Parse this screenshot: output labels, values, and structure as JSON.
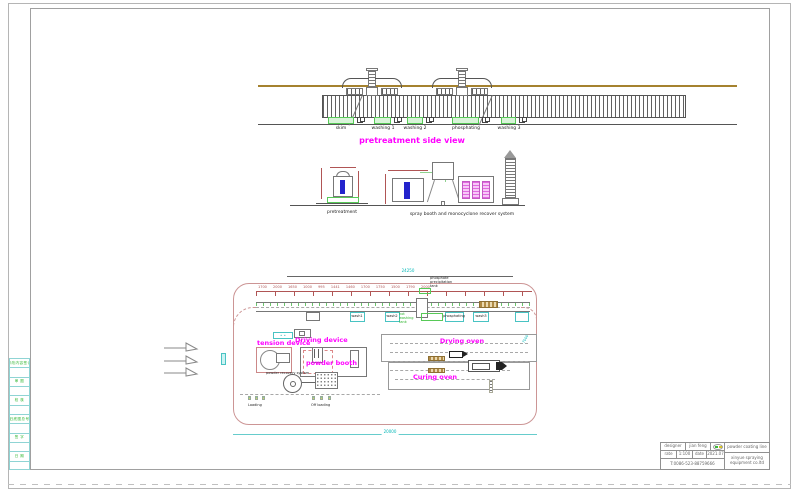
{
  "left_strip": {
    "rows": [
      "修改内容签记",
      "审 图",
      "校 核",
      "旧底图总号",
      "签 字",
      "日 期"
    ]
  },
  "side_view": {
    "title": "pretreatment side view",
    "tanks": [
      "skim",
      "washing 1",
      "washing 2",
      "phosphating",
      "washing 3"
    ]
  },
  "sections": {
    "pretreatment": "pretreatment",
    "spray_system": "spray booth and monocyclone recover system"
  },
  "plan": {
    "dim_total_top": "24250",
    "dim_numbers": "1700 2000 1650 1000 995 1441 1460 1700 1750 1500 1790 2000",
    "dim_total_bottom": "20000",
    "dim_right": "7000",
    "phosphate_note": "phosphate\nprecipitation\ntank",
    "hot_wash_note": "hot\nwashing\ntank",
    "tank_labels": [
      "wash1",
      "wash2",
      "phosphating",
      "wash3"
    ],
    "tension": "tension device",
    "driving": "Driving device",
    "booth": "powder booth",
    "recovery": "powder recovery system",
    "drying": "Drying oven",
    "curing": "Curing oven",
    "loading": "Loading",
    "offloading": "Off loading",
    "dot_marks": "• •"
  },
  "title_block": {
    "designer_label": "designer",
    "designer": "jian feng",
    "rate_label": "rate",
    "rate": "1:100",
    "date_label": "date",
    "date": "2021.07",
    "phone": "T:0086-523-88759666",
    "product": "powder coating line",
    "company": "xinyue spraying\nequipment co.ltd"
  },
  "colors": {
    "magenta": "#ff00ff",
    "cyan": "#00b7b7",
    "green": "#2db52d",
    "tan": "#a5822f",
    "blue": "#2323cc",
    "dim_red": "#b05555",
    "boundary_pink": "#cc9595"
  }
}
